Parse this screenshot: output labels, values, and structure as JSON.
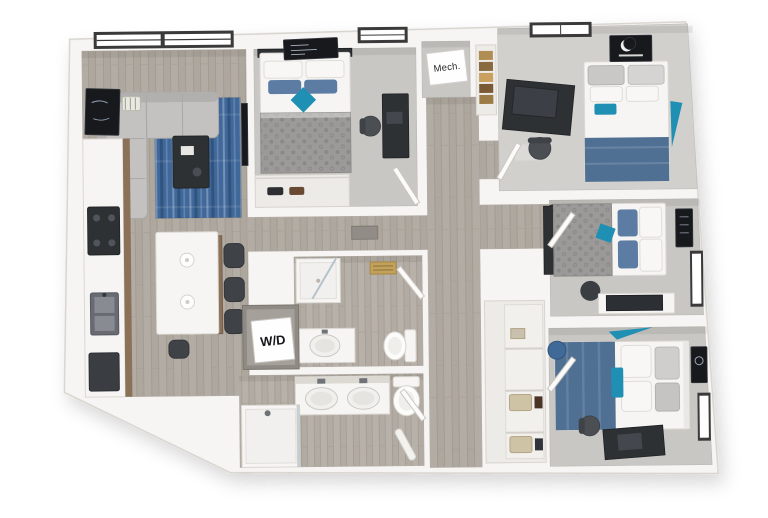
{
  "floor_plan": {
    "type": "3d-rendered-floor-plan",
    "labels": {
      "mech": "Mech.",
      "wd": "W/D"
    },
    "rooms": [
      "living-room",
      "kitchen",
      "bedroom-1",
      "bedroom-2",
      "bedroom-3",
      "bedroom-4",
      "bathroom-top",
      "bathroom-bottom",
      "wd-closet",
      "mech-room",
      "hallway",
      "storage-closet"
    ],
    "colors": {
      "background": "#ffffff",
      "wall": "#f7f5f3",
      "wall_edge": "#d8d4cf",
      "wood_floor": "#aea79e",
      "wood_line": "#9c958c",
      "bath_floor": "#b2aba3",
      "carpet": "#c9c7c3",
      "carpet_light": "#d2d0cd",
      "niche": "#edebe7",
      "linen_white": "#f6f5f3",
      "rug_blue": "#40689a",
      "rug_streak": "#31547e",
      "accent_teal": "#1f8fb4",
      "blanket_blue": "#4f6f93",
      "pillow_blue": "#5d7ca3",
      "duvet_gray": "#9b9a98",
      "duvet_dot": "#8a8987",
      "dark_furniture": "#2e3134",
      "chair_gray": "#4b4f54",
      "cabinet_wood": "#8a7158",
      "frame_dark": "#17191d",
      "basket_tan": "#cfc3a6",
      "gold_vent": "#c2a15c",
      "window_frame": "#3a3a3a",
      "text_dark": "#26262a"
    }
  }
}
